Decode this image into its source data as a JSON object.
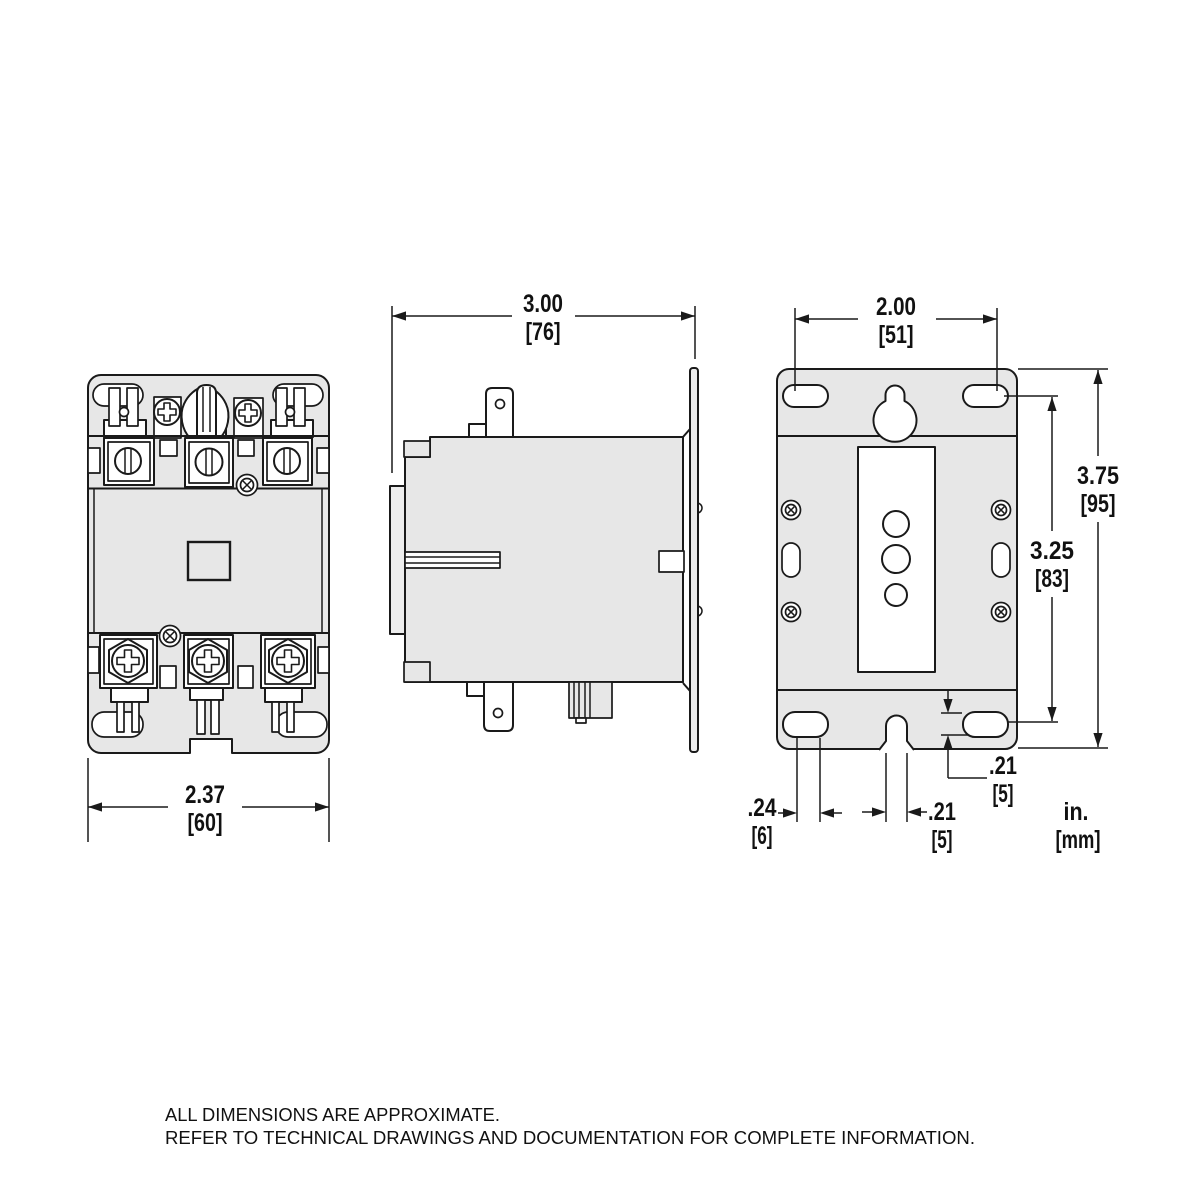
{
  "image": {
    "background": "#ffffff",
    "line_color": "#1a1a1a",
    "body_fill": "#e7e7e7",
    "detail_fill": "#ffffff"
  },
  "dimensions": {
    "front_width": {
      "in": "2.37",
      "mm": "[60]"
    },
    "side_depth": {
      "in": "3.00",
      "mm": "[76]"
    },
    "slot_spacing": {
      "in": "2.00",
      "mm": "[51]"
    },
    "overall_height": {
      "in": "3.75",
      "mm": "[95]"
    },
    "slot_span": {
      "in": "3.25",
      "mm": "[83]"
    },
    "slot_height": {
      "in": ".21",
      "mm": "[5]"
    },
    "notch_width": {
      "in": ".21",
      "mm": "[5]"
    },
    "slot_width": {
      "in": ".24",
      "mm": "[6]"
    }
  },
  "units_legend": {
    "in": "in.",
    "mm": "[mm]"
  },
  "footer": {
    "line1": "ALL DIMENSIONS ARE APPROXIMATE.",
    "line2": "REFER TO TECHNICAL DRAWINGS AND DOCUMENTATION FOR COMPLETE INFORMATION."
  }
}
